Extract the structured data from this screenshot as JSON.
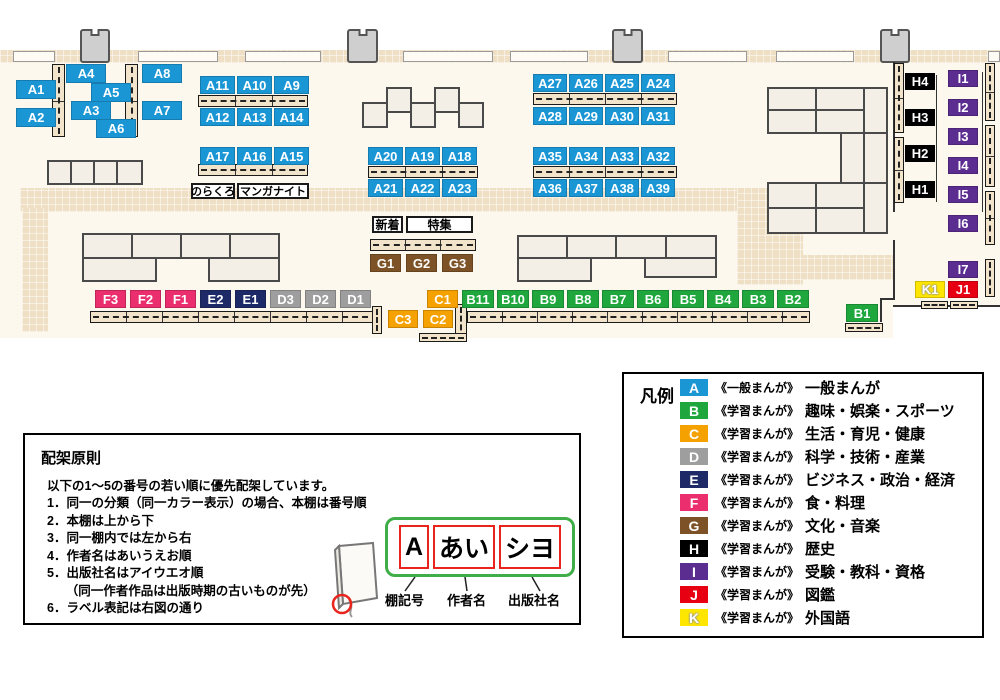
{
  "colors": {
    "a_blue": "#1b96d5",
    "b_green": "#1fa73e",
    "c_orange": "#f5a100",
    "d_gray": "#9e9e9f",
    "e_navy": "#1e2a68",
    "f_pink": "#ea2e6e",
    "g_brown": "#7d5226",
    "h_black": "#000000",
    "i_purple": "#5c2d91",
    "j_red": "#e60012",
    "k_yellow": "#ffe600"
  },
  "map": {
    "cluster_a": [
      "A1",
      "A2",
      "A4",
      "A5",
      "A3",
      "A6",
      "A8",
      "A7"
    ],
    "row_a9": [
      "A11",
      "A10",
      "A9"
    ],
    "row_a12": [
      "A12",
      "A13",
      "A14"
    ],
    "row_a15": [
      "A17",
      "A16",
      "A15"
    ],
    "row_a18": [
      "A20",
      "A19",
      "A18"
    ],
    "row_a21": [
      "A21",
      "A22",
      "A23"
    ],
    "row_a24": [
      "A27",
      "A26",
      "A25",
      "A24"
    ],
    "row_a28": [
      "A28",
      "A29",
      "A30",
      "A31"
    ],
    "row_a32": [
      "A35",
      "A34",
      "A33",
      "A32"
    ],
    "row_a36": [
      "A36",
      "A37",
      "A38",
      "A39"
    ],
    "row_g": [
      "G1",
      "G2",
      "G3"
    ],
    "row_fed": [
      {
        "t": "F3",
        "bg": "#ea2e6e"
      },
      {
        "t": "F2",
        "bg": "#ea2e6e"
      },
      {
        "t": "F1",
        "bg": "#ea2e6e"
      },
      {
        "t": "E2",
        "bg": "#1e2a68"
      },
      {
        "t": "E1",
        "bg": "#1e2a68"
      },
      {
        "t": "D3",
        "bg": "#9e9e9f"
      },
      {
        "t": "D2",
        "bg": "#9e9e9f"
      },
      {
        "t": "D1",
        "bg": "#9e9e9f"
      }
    ],
    "tag_c1": "C1",
    "row_b": [
      "B11",
      "B10",
      "B9",
      "B8",
      "B7",
      "B6",
      "B5",
      "B4",
      "B3",
      "B2"
    ],
    "row_c32": [
      "C3",
      "C2"
    ],
    "tag_b1": "B1",
    "col_h": [
      "H4",
      "H3",
      "H2",
      "H1"
    ],
    "col_i": [
      "I1",
      "I2",
      "I3",
      "I4",
      "I5",
      "I6"
    ],
    "tag_i7": "I7",
    "tag_k1": "K1",
    "tag_j1": "J1",
    "notes": {
      "norakuro": "のらくろ",
      "manganight": "マンガナイト",
      "shinchaku": "新着",
      "tokushu": "特集"
    }
  },
  "legend": {
    "title": "凡例",
    "items": [
      {
        "letter": "A",
        "bg": "#1b96d5",
        "series": "《一般まんが》",
        "category": "一般まんが"
      },
      {
        "letter": "B",
        "bg": "#1fa73e",
        "series": "《学習まんが》",
        "category": "趣味・娯楽・スポーツ"
      },
      {
        "letter": "C",
        "bg": "#f5a100",
        "series": "《学習まんが》",
        "category": "生活・育児・健康"
      },
      {
        "letter": "D",
        "bg": "#9e9e9f",
        "series": "《学習まんが》",
        "category": "科学・技術・産業"
      },
      {
        "letter": "E",
        "bg": "#1e2a68",
        "series": "《学習まんが》",
        "category": "ビジネス・政治・経済"
      },
      {
        "letter": "F",
        "bg": "#ea2e6e",
        "series": "《学習まんが》",
        "category": "食・料理"
      },
      {
        "letter": "G",
        "bg": "#7d5226",
        "series": "《学習まんが》",
        "category": "文化・音楽"
      },
      {
        "letter": "H",
        "bg": "#000000",
        "series": "《学習まんが》",
        "category": "歴史"
      },
      {
        "letter": "I",
        "bg": "#5c2d91",
        "series": "《学習まんが》",
        "category": "受験・教科・資格"
      },
      {
        "letter": "J",
        "bg": "#e60012",
        "series": "《学習まんが》",
        "category": "図鑑"
      },
      {
        "letter": "K",
        "bg": "#ffe600",
        "series": "《学習まんが》",
        "category": "外国語",
        "letter_shadow": "0 0 2px #999, 0 0 2px #999, 0 0 1px #777"
      }
    ]
  },
  "principles": {
    "title": "配架原則",
    "intro": "以下の1～5の番号の若い順に優先配架しています。",
    "rules": [
      "1．同一の分類（同一カラー表示）の場合、本棚は番号順",
      "2．本棚は上から下",
      "3．同一棚内では左から右",
      "4．作者名はあいうえお順",
      "5．出版社名はアイウエオ順",
      "　　（同一作者作品は出版時期の古いものが先）",
      "6．ラベル表記は右図の通り"
    ],
    "label_diagram": {
      "boxes": [
        "A",
        "あい",
        "シヨ"
      ],
      "captions": [
        "棚記号",
        "作者名",
        "出版社名"
      ]
    }
  }
}
